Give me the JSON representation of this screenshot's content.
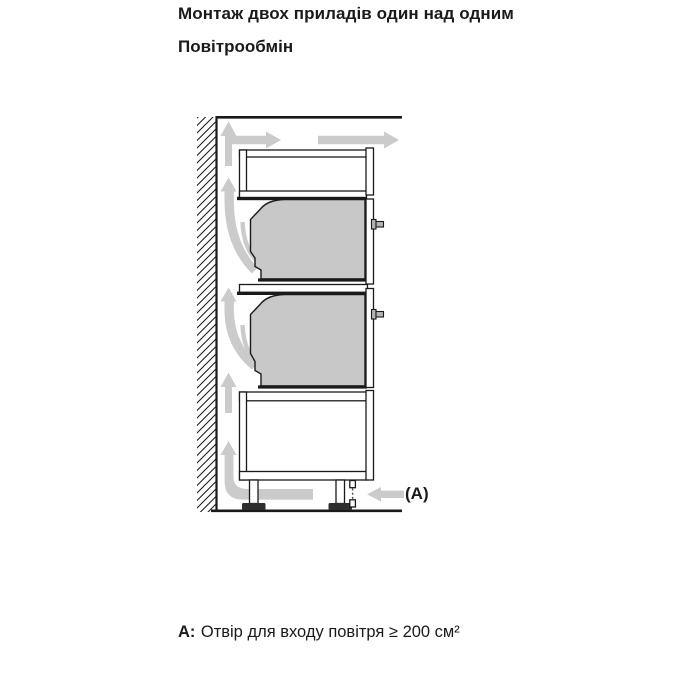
{
  "page": {
    "title": "Монтаж двох приладів один над одним",
    "subtitle": "Повітрообмін",
    "diagram_label": "(A)",
    "note_prefix": "A:",
    "note_text": "Отвір для входу повітря ≥ 200 см²"
  },
  "colors": {
    "background": "#ffffff",
    "line": "#1a1a1a",
    "appliance": "#c8c8c8",
    "arrow": "#cbcbcb",
    "bolt": "#b3b3b3",
    "foot": "#2f2f2f"
  }
}
